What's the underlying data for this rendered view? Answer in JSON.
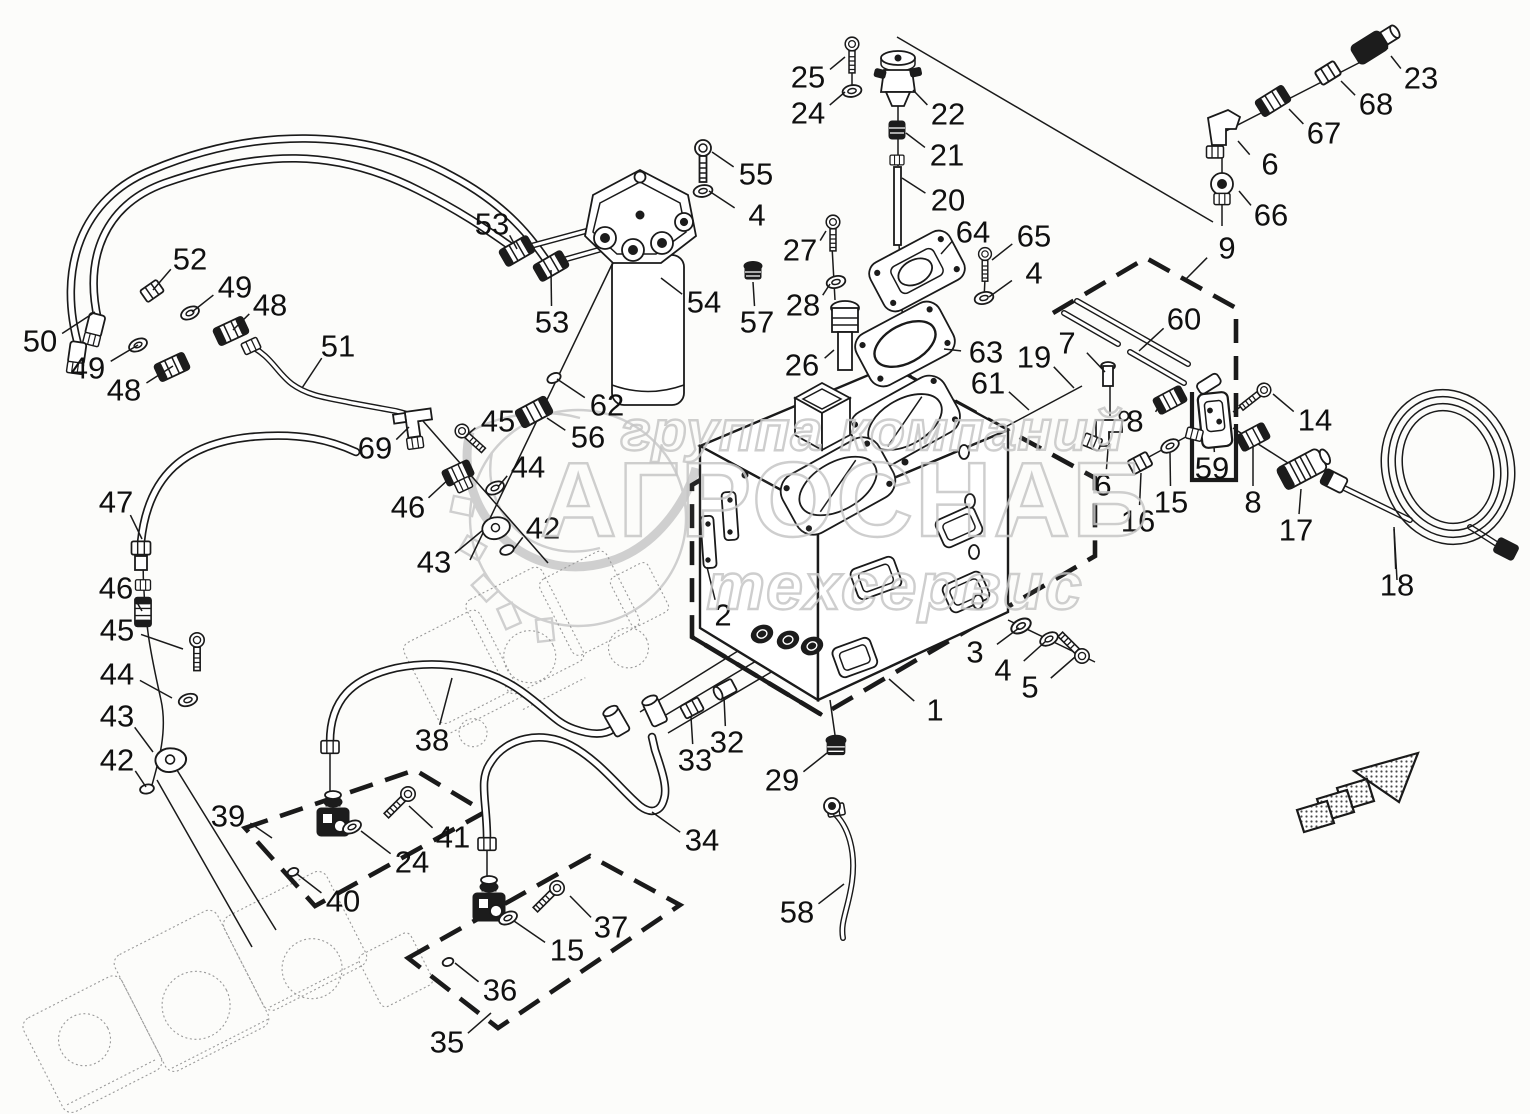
{
  "watermark": {
    "line1": "группа компаний",
    "line2": "АГРОСНАБ",
    "line3": "техсервис",
    "color": "#c6c6c6"
  },
  "diagram": {
    "type": "exploded-parts-diagram",
    "subject": "hydraulic-oil-tank-assembly",
    "line_color": "#1a1a1a",
    "background": "#fcfcfa",
    "part_labels": [
      {
        "t": "50",
        "x": 40,
        "y": 341,
        "lx": 95,
        "ly": 312
      },
      {
        "t": "52",
        "x": 190,
        "y": 259,
        "lx": 153,
        "ly": 290
      },
      {
        "t": "49",
        "x": 235,
        "y": 287,
        "lx": 192,
        "ly": 312
      },
      {
        "t": "48",
        "x": 270,
        "y": 305,
        "lx": 233,
        "ly": 330
      },
      {
        "t": "49",
        "x": 88,
        "y": 368,
        "lx": 138,
        "ly": 345
      },
      {
        "t": "48",
        "x": 124,
        "y": 390,
        "lx": 173,
        "ly": 366
      },
      {
        "t": "51",
        "x": 338,
        "y": 346,
        "lx": 302,
        "ly": 388
      },
      {
        "t": "53",
        "x": 492,
        "y": 224,
        "lx": 517,
        "ly": 249
      },
      {
        "t": "53",
        "x": 552,
        "y": 322,
        "lx": 551,
        "ly": 270
      },
      {
        "t": "55",
        "x": 756,
        "y": 174,
        "lx": 712,
        "ly": 152
      },
      {
        "t": "4",
        "x": 757,
        "y": 215,
        "lx": 709,
        "ly": 191
      },
      {
        "t": "54",
        "x": 704,
        "y": 302,
        "lx": 661,
        "ly": 278
      },
      {
        "t": "57",
        "x": 757,
        "y": 322,
        "lx": 753,
        "ly": 282
      },
      {
        "t": "62",
        "x": 607,
        "y": 405,
        "lx": 557,
        "ly": 379
      },
      {
        "t": "56",
        "x": 588,
        "y": 437,
        "lx": 547,
        "ly": 418
      },
      {
        "t": "27",
        "x": 800,
        "y": 250,
        "lx": 826,
        "ly": 231
      },
      {
        "t": "28",
        "x": 803,
        "y": 305,
        "lx": 830,
        "ly": 284
      },
      {
        "t": "26",
        "x": 802,
        "y": 365,
        "lx": 834,
        "ly": 350
      },
      {
        "t": "25",
        "x": 808,
        "y": 77,
        "lx": 845,
        "ly": 57
      },
      {
        "t": "24",
        "x": 808,
        "y": 113,
        "lx": 845,
        "ly": 92
      },
      {
        "t": "22",
        "x": 948,
        "y": 114,
        "lx": 913,
        "ly": 90
      },
      {
        "t": "21",
        "x": 947,
        "y": 155,
        "lx": 906,
        "ly": 133
      },
      {
        "t": "20",
        "x": 948,
        "y": 200,
        "lx": 902,
        "ly": 178
      },
      {
        "t": "64",
        "x": 973,
        "y": 232,
        "lx": 941,
        "ly": 254
      },
      {
        "t": "65",
        "x": 1034,
        "y": 236,
        "lx": 992,
        "ly": 260
      },
      {
        "t": "4",
        "x": 1034,
        "y": 273,
        "lx": 989,
        "ly": 297
      },
      {
        "t": "63",
        "x": 986,
        "y": 352,
        "lx": 944,
        "ly": 349
      },
      {
        "t": "23",
        "x": 1421,
        "y": 78,
        "lx": 1391,
        "ly": 56
      },
      {
        "t": "68",
        "x": 1376,
        "y": 104,
        "lx": 1341,
        "ly": 81
      },
      {
        "t": "67",
        "x": 1324,
        "y": 133,
        "lx": 1289,
        "ly": 109
      },
      {
        "t": "6",
        "x": 1270,
        "y": 164,
        "lx": 1238,
        "ly": 141
      },
      {
        "t": "66",
        "x": 1271,
        "y": 215,
        "lx": 1239,
        "ly": 191
      },
      {
        "t": "9",
        "x": 1227,
        "y": 248,
        "lx": 1185,
        "ly": 280
      },
      {
        "t": "60",
        "x": 1184,
        "y": 319,
        "lx": 1139,
        "ly": 351
      },
      {
        "t": "7",
        "x": 1067,
        "y": 343,
        "lx": 1105,
        "ly": 372
      },
      {
        "t": "19",
        "x": 1034,
        "y": 357,
        "lx": 1074,
        "ly": 388
      },
      {
        "t": "61",
        "x": 988,
        "y": 383,
        "lx": 1029,
        "ly": 410
      },
      {
        "t": "8",
        "x": 1135,
        "y": 421,
        "lx": 1161,
        "ly": 403
      },
      {
        "t": "14",
        "x": 1315,
        "y": 420,
        "lx": 1273,
        "ly": 394
      },
      {
        "t": "59",
        "x": 1212,
        "y": 468,
        "lx": 1214,
        "ly": 447
      },
      {
        "t": "6",
        "x": 1103,
        "y": 485,
        "lx": 1108,
        "ly": 449
      },
      {
        "t": "16",
        "x": 1138,
        "y": 521,
        "lx": 1141,
        "ly": 473
      },
      {
        "t": "15",
        "x": 1171,
        "y": 502,
        "lx": 1170,
        "ly": 453
      },
      {
        "t": "8",
        "x": 1253,
        "y": 502,
        "lx": 1253,
        "ly": 447
      },
      {
        "t": "17",
        "x": 1296,
        "y": 530,
        "lx": 1301,
        "ly": 489
      },
      {
        "t": "18",
        "x": 1397,
        "y": 585,
        "lx": 1394,
        "ly": 529
      },
      {
        "t": "2",
        "x": 723,
        "y": 615,
        "lx": 707,
        "ly": 567
      },
      {
        "t": "1",
        "x": 935,
        "y": 710,
        "lx": 889,
        "ly": 679
      },
      {
        "t": "3",
        "x": 975,
        "y": 652,
        "lx": 1019,
        "ly": 628
      },
      {
        "t": "4",
        "x": 1003,
        "y": 670,
        "lx": 1046,
        "ly": 641
      },
      {
        "t": "5",
        "x": 1030,
        "y": 687,
        "lx": 1075,
        "ly": 657
      },
      {
        "t": "29",
        "x": 782,
        "y": 780,
        "lx": 827,
        "ly": 753
      },
      {
        "t": "32",
        "x": 727,
        "y": 742,
        "lx": 724,
        "ly": 697
      },
      {
        "t": "33",
        "x": 695,
        "y": 760,
        "lx": 691,
        "ly": 717
      },
      {
        "t": "58",
        "x": 797,
        "y": 912,
        "lx": 844,
        "ly": 884
      },
      {
        "t": "34",
        "x": 702,
        "y": 840,
        "lx": 652,
        "ly": 812
      },
      {
        "t": "38",
        "x": 432,
        "y": 740,
        "lx": 452,
        "ly": 678
      },
      {
        "t": "39",
        "x": 228,
        "y": 816,
        "lx": 272,
        "ly": 838
      },
      {
        "t": "41",
        "x": 453,
        "y": 837,
        "lx": 409,
        "ly": 806
      },
      {
        "t": "24",
        "x": 412,
        "y": 862,
        "lx": 361,
        "ly": 831
      },
      {
        "t": "40",
        "x": 343,
        "y": 901,
        "lx": 297,
        "ly": 874
      },
      {
        "t": "36",
        "x": 500,
        "y": 990,
        "lx": 455,
        "ly": 963
      },
      {
        "t": "35",
        "x": 447,
        "y": 1042,
        "lx": 491,
        "ly": 1013
      },
      {
        "t": "37",
        "x": 611,
        "y": 927,
        "lx": 570,
        "ly": 896
      },
      {
        "t": "15",
        "x": 567,
        "y": 950,
        "lx": 514,
        "ly": 921
      },
      {
        "t": "47",
        "x": 116,
        "y": 502,
        "lx": 142,
        "ly": 539
      },
      {
        "t": "46",
        "x": 116,
        "y": 588,
        "lx": 142,
        "ly": 611
      },
      {
        "t": "45",
        "x": 117,
        "y": 630,
        "lx": 183,
        "ly": 649
      },
      {
        "t": "44",
        "x": 117,
        "y": 674,
        "lx": 172,
        "ly": 698
      },
      {
        "t": "43",
        "x": 117,
        "y": 716,
        "lx": 153,
        "ly": 752
      },
      {
        "t": "42",
        "x": 117,
        "y": 760,
        "lx": 146,
        "ly": 787
      },
      {
        "t": "69",
        "x": 375,
        "y": 448,
        "lx": 409,
        "ly": 427
      },
      {
        "t": "45",
        "x": 498,
        "y": 421,
        "lx": 466,
        "ly": 436
      },
      {
        "t": "44",
        "x": 528,
        "y": 467,
        "lx": 498,
        "ly": 487
      },
      {
        "t": "46",
        "x": 408,
        "y": 507,
        "lx": 451,
        "ly": 477
      },
      {
        "t": "43",
        "x": 434,
        "y": 562,
        "lx": 483,
        "ly": 530
      },
      {
        "t": "42",
        "x": 543,
        "y": 528,
        "lx": 514,
        "ly": 549
      }
    ]
  }
}
